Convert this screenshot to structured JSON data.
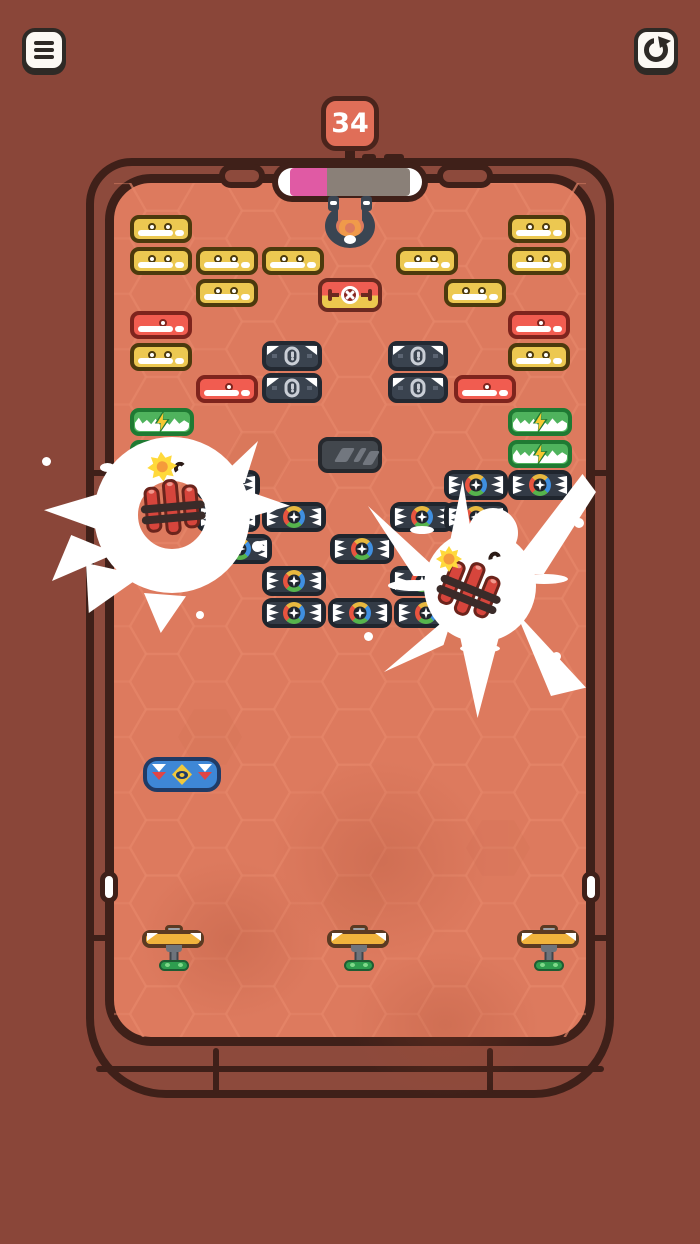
{
  "hud": {
    "level": "34",
    "menu_button": {
      "icon": "hamburger-menu"
    },
    "restart_button": {
      "icon": "restart-arrow"
    },
    "progress": {
      "percent": 31,
      "fill_color": "#E05AA4",
      "rest_color": "#8A8078"
    }
  },
  "board": {
    "brick_sizes": {
      "yellow": {
        "w": 62,
        "h": 28
      },
      "red": {
        "w": 62,
        "h": 28
      },
      "dark": {
        "w": 60,
        "h": 30
      },
      "green": {
        "w": 64,
        "h": 28
      },
      "glass": {
        "w": 64,
        "h": 36
      },
      "shuriken": {
        "w": 64,
        "h": 30
      },
      "detonator": {
        "w": 64,
        "h": 34
      }
    },
    "brick_legend": {
      "yellow": "two-dot brick",
      "red": "one-dot brick",
      "dark": "armored exclamation brick",
      "green": "lightning brick",
      "glass": "reinforced glass brick",
      "shuriken": "rainbow star brick",
      "detonator": "detonator brick"
    },
    "bricks": [
      {
        "type": "yellow",
        "x": 130,
        "y": 215
      },
      {
        "type": "yellow",
        "x": 508,
        "y": 215
      },
      {
        "type": "yellow",
        "x": 130,
        "y": 247
      },
      {
        "type": "yellow",
        "x": 196,
        "y": 247
      },
      {
        "type": "yellow",
        "x": 262,
        "y": 247
      },
      {
        "type": "yellow",
        "x": 396,
        "y": 247
      },
      {
        "type": "yellow",
        "x": 508,
        "y": 247
      },
      {
        "type": "yellow",
        "x": 196,
        "y": 279
      },
      {
        "type": "yellow",
        "x": 444,
        "y": 279
      },
      {
        "type": "detonator",
        "x": 318,
        "y": 278
      },
      {
        "type": "red",
        "x": 130,
        "y": 311
      },
      {
        "type": "red",
        "x": 508,
        "y": 311
      },
      {
        "type": "yellow",
        "x": 130,
        "y": 343
      },
      {
        "type": "yellow",
        "x": 508,
        "y": 343
      },
      {
        "type": "dark",
        "x": 262,
        "y": 341
      },
      {
        "type": "dark",
        "x": 388,
        "y": 341
      },
      {
        "type": "red",
        "x": 196,
        "y": 375
      },
      {
        "type": "dark",
        "x": 262,
        "y": 373
      },
      {
        "type": "dark",
        "x": 388,
        "y": 373
      },
      {
        "type": "red",
        "x": 454,
        "y": 375
      },
      {
        "type": "green",
        "x": 130,
        "y": 408
      },
      {
        "type": "green",
        "x": 508,
        "y": 408
      },
      {
        "type": "green",
        "x": 130,
        "y": 440
      },
      {
        "type": "green",
        "x": 508,
        "y": 440
      },
      {
        "type": "glass",
        "x": 318,
        "y": 437
      },
      {
        "type": "shuriken",
        "x": 196,
        "y": 470
      },
      {
        "type": "shuriken",
        "x": 444,
        "y": 470
      },
      {
        "type": "shuriken",
        "x": 508,
        "y": 470
      },
      {
        "type": "shuriken",
        "x": 196,
        "y": 502
      },
      {
        "type": "shuriken",
        "x": 262,
        "y": 502
      },
      {
        "type": "shuriken",
        "x": 390,
        "y": 502
      },
      {
        "type": "shuriken",
        "x": 444,
        "y": 502
      },
      {
        "type": "shuriken",
        "x": 208,
        "y": 534
      },
      {
        "type": "shuriken",
        "x": 330,
        "y": 534
      },
      {
        "type": "shuriken",
        "x": 262,
        "y": 566
      },
      {
        "type": "shuriken",
        "x": 390,
        "y": 566
      },
      {
        "type": "shuriken",
        "x": 262,
        "y": 598
      },
      {
        "type": "shuriken",
        "x": 328,
        "y": 598
      },
      {
        "type": "shuriken",
        "x": 394,
        "y": 598
      }
    ],
    "magnet": {
      "x": 350,
      "y": 222
    },
    "powerup_capsule": {
      "x": 143,
      "y": 757
    },
    "launchers": [
      {
        "x": 142,
        "y": 924
      },
      {
        "x": 327,
        "y": 924
      },
      {
        "x": 517,
        "y": 924
      }
    ],
    "explosions": [
      {
        "kind": "ring",
        "cx": 172,
        "cy": 515
      },
      {
        "kind": "burst",
        "cx": 480,
        "cy": 588
      }
    ],
    "wall_notches": [
      {
        "x": 100,
        "y": 871
      },
      {
        "x": 582,
        "y": 871
      }
    ]
  },
  "colors": {
    "background": "#8A4639",
    "frame": "#8D4A3C",
    "frame_outline": "#3F2019",
    "field": "#DD7A5E",
    "hex_line": "#E8876A",
    "badge": "#E06E58",
    "button_bg": "#FCF9F4",
    "button_icon": "#2E2A26",
    "progress_fill": "#E05AA4",
    "progress_rest": "#8A8078",
    "brick_yellow": "#ECC851",
    "brick_red": "#F15C50",
    "brick_dark": "#3A434F",
    "brick_green": "#4FB35D",
    "brick_glass": "#42474D",
    "brick_shuriken": "#333B46",
    "bolt_yellow": "#F7C831",
    "tnt_red": "#D6453C",
    "spark_yellow": "#FFD93B",
    "spark_orange": "#F59B3B",
    "magnet_navy": "#3A4552",
    "magnet_orange": "#F09A4A",
    "capsule_blue": "#3E87D6",
    "launcher_yellow": "#F0B33C",
    "launcher_green": "#2E9E4F"
  }
}
